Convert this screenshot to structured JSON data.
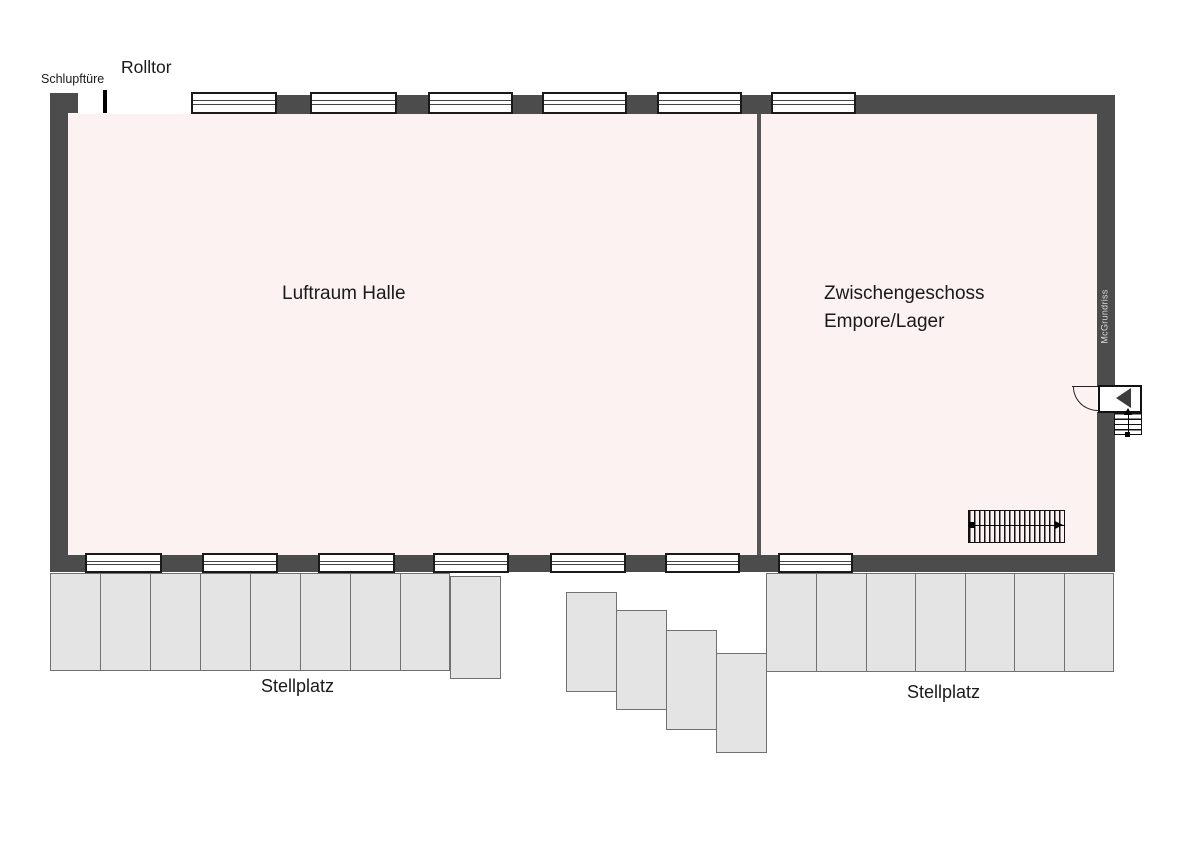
{
  "labels": {
    "schlupftuere": "Schlupftüre",
    "rolltor": "Rolltor",
    "hall": "Luftraum Halle",
    "mezzanine_line1": "Zwischengeschoss",
    "mezzanine_line2": "Empore/Lager",
    "stellplatz_left": "Stellplatz",
    "stellplatz_right": "Stellplatz",
    "watermark": "McGrundriss"
  },
  "colors": {
    "wall": "#4c4c4c",
    "interior": "#fcf2f2",
    "stall_fill": "#e4e4e4",
    "stall_border": "#707070",
    "window_border": "#1a1a1a",
    "background": "#ffffff"
  },
  "geometry": {
    "top_windows": [
      {
        "x": 191,
        "y": 92,
        "w": 86,
        "h": 22
      },
      {
        "x": 310,
        "y": 92,
        "w": 87,
        "h": 22
      },
      {
        "x": 428,
        "y": 92,
        "w": 85,
        "h": 22
      },
      {
        "x": 542,
        "y": 92,
        "w": 85,
        "h": 22
      },
      {
        "x": 657,
        "y": 92,
        "w": 85,
        "h": 22
      },
      {
        "x": 771,
        "y": 92,
        "w": 85,
        "h": 22
      }
    ],
    "bottom_windows": [
      {
        "x": 85,
        "y": 553,
        "w": 77,
        "h": 20
      },
      {
        "x": 202,
        "y": 553,
        "w": 76,
        "h": 20
      },
      {
        "x": 318,
        "y": 553,
        "w": 77,
        "h": 20
      },
      {
        "x": 433,
        "y": 553,
        "w": 76,
        "h": 20
      },
      {
        "x": 550,
        "y": 553,
        "w": 76,
        "h": 20
      },
      {
        "x": 665,
        "y": 553,
        "w": 75,
        "h": 20
      },
      {
        "x": 778,
        "y": 553,
        "w": 75,
        "h": 20
      }
    ],
    "stalls_left": [
      {
        "x": 50,
        "y": 573,
        "w": 51,
        "h": 98
      },
      {
        "x": 100,
        "y": 573,
        "w": 51,
        "h": 98
      },
      {
        "x": 150,
        "y": 573,
        "w": 51,
        "h": 98
      },
      {
        "x": 200,
        "y": 573,
        "w": 51,
        "h": 98
      },
      {
        "x": 250,
        "y": 573,
        "w": 51,
        "h": 98
      },
      {
        "x": 300,
        "y": 573,
        "w": 51,
        "h": 98
      },
      {
        "x": 350,
        "y": 573,
        "w": 51,
        "h": 98
      },
      {
        "x": 400,
        "y": 573,
        "w": 50,
        "h": 98
      },
      {
        "x": 450,
        "y": 576,
        "w": 51,
        "h": 103
      }
    ],
    "stalls_middle": [
      {
        "x": 566,
        "y": 592,
        "w": 51,
        "h": 100
      },
      {
        "x": 616,
        "y": 610,
        "w": 51,
        "h": 100
      },
      {
        "x": 666,
        "y": 630,
        "w": 51,
        "h": 100
      },
      {
        "x": 716,
        "y": 653,
        "w": 51,
        "h": 100
      }
    ],
    "stalls_right": [
      {
        "x": 766,
        "y": 573,
        "w": 51,
        "h": 99
      },
      {
        "x": 816,
        "y": 573,
        "w": 51,
        "h": 99
      },
      {
        "x": 866,
        "y": 573,
        "w": 50,
        "h": 99
      },
      {
        "x": 915,
        "y": 573,
        "w": 51,
        "h": 99
      },
      {
        "x": 965,
        "y": 573,
        "w": 50,
        "h": 99
      },
      {
        "x": 1014,
        "y": 573,
        "w": 51,
        "h": 99
      },
      {
        "x": 1064,
        "y": 573,
        "w": 50,
        "h": 99
      }
    ]
  }
}
